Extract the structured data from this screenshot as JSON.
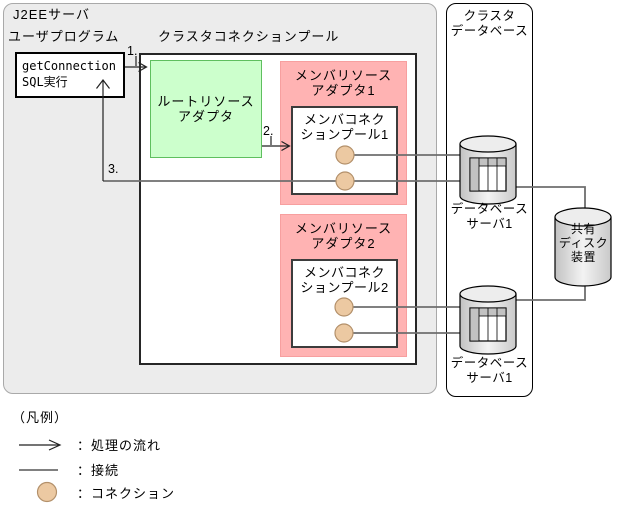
{
  "diagram": {
    "j2ee_server": {
      "label": "J2EEサーバ"
    },
    "user_program": {
      "label": "ユーザプログラム",
      "call_lines": [
        "getConnection",
        "SQL実行"
      ]
    },
    "cluster_pool": {
      "label": "クラスタコネクションプール"
    },
    "root_adapter": {
      "lines": [
        "ルートリソース",
        "アダプタ"
      ]
    },
    "member_adapter1": {
      "lines": [
        "メンバリソース",
        "アダプタ1"
      ]
    },
    "member_pool1": {
      "lines": [
        "メンバコネク",
        "ションプール1"
      ],
      "connection_count": 2
    },
    "member_adapter2": {
      "lines": [
        "メンバリソース",
        "アダプタ2"
      ]
    },
    "member_pool2": {
      "lines": [
        "メンバコネク",
        "ションプール2"
      ],
      "connection_count": 2
    },
    "cluster_database": {
      "lines": [
        "クラスタ",
        "データベース"
      ]
    },
    "db_server1": {
      "lines": [
        "データベース",
        "サーバ1"
      ]
    },
    "db_server2": {
      "lines": [
        "データベース",
        "サーバ1"
      ]
    },
    "shared_disk": {
      "lines": [
        "共有",
        "ディスク",
        "装置"
      ]
    },
    "steps": [
      "1.",
      "2.",
      "3."
    ]
  },
  "legend": {
    "title": "（凡例）",
    "items": [
      {
        "icon": "flow-arrow-icon",
        "label": "：処理の流れ"
      },
      {
        "icon": "connection-line-icon",
        "label": "：接続"
      },
      {
        "icon": "connection-circle-icon",
        "label": "：コネクション"
      }
    ]
  },
  "colors": {
    "j2ee_bg": "#ececec",
    "root_adapter_fill": "#ccffcc",
    "root_adapter_border": "#5fbf5f",
    "member_adapter_fill": "#ffb3b3",
    "connection_fill": "#ecc9a2",
    "connection_border": "#b3906a",
    "cylinder_fill": "#d9d9d9",
    "connection_line": "#6e6e6e",
    "flow_arrow": "#222222"
  }
}
